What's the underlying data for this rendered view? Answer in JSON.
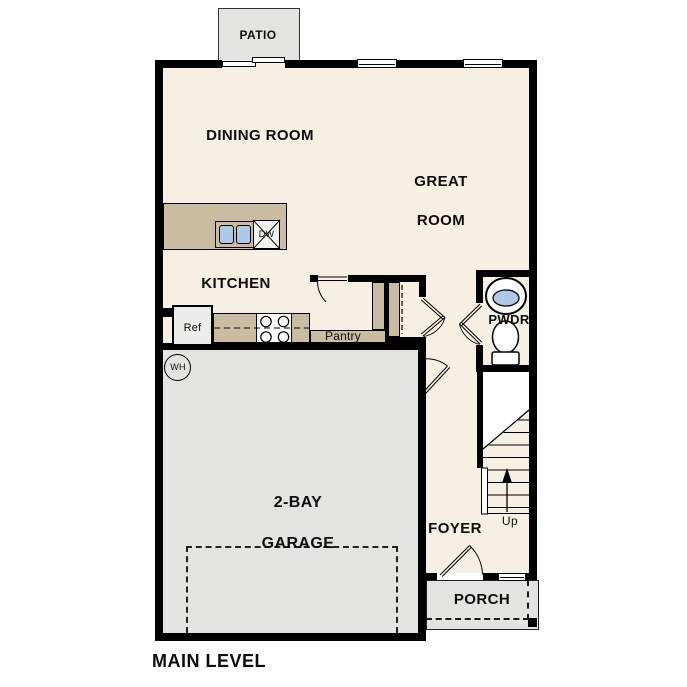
{
  "plan": {
    "level_label": "MAIN LEVEL",
    "rooms": {
      "patio": "PATIO",
      "dining_room": "DINING ROOM",
      "great_room_line1": "GREAT",
      "great_room_line2": "ROOM",
      "kitchen": "KITCHEN",
      "pantry": "Pantry",
      "powder_room": "PWDR",
      "garage_line1": "2-BAY",
      "garage_line2": "GARAGE",
      "foyer": "FOYER",
      "porch": "PORCH"
    },
    "fixtures": {
      "refrigerator": "Ref",
      "dishwasher": "DW",
      "water_heater": "WH",
      "stair_direction": "Up"
    },
    "colors": {
      "floor": "#f7efe2",
      "concrete": "#e3e3e1",
      "counter": "#c9bca0",
      "sink_blue": "#aec9e8",
      "wall": "#000000"
    }
  }
}
